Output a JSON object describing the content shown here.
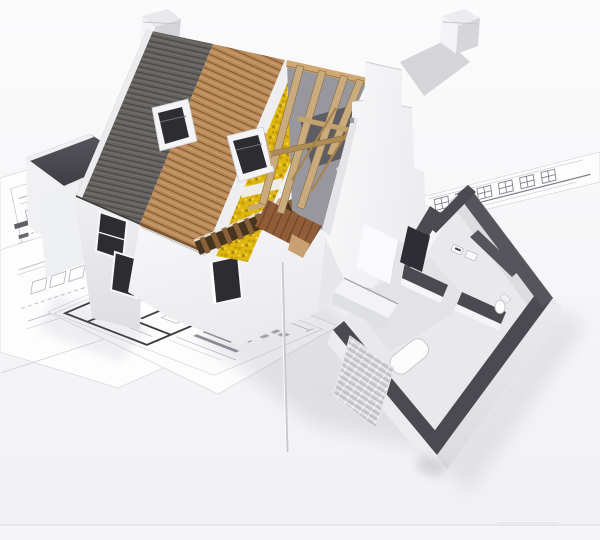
{
  "scene": {
    "description": "3D cutaway architectural rendering of a house under construction standing on spread-out blueprint floor plans against a white background. The roof is peeled back in strips showing slate tiles, timber decking, membrane, yellow mineral insulation and open rafters; a stepped gable wall, two skylights and two chimneys are visible; the single-storey wing is roofless, exposing rooms with dark-grey cut wall tops, kitchen units and bathroom fixtures.",
    "background_top": "#fbfbfc",
    "background_bottom": "#f1f1f4"
  },
  "palette": {
    "roof_tile": "#666360",
    "roof_tile_dark": "#4d4b49",
    "wood_deck": "#b9895a",
    "wood_deck_dark": "#7e5631",
    "insulation_yellow": "#dfb60e",
    "insulation_dark": "#a8870a",
    "insulation_light": "#f0cf3e",
    "rafter_wood": "#c9ab7e",
    "purlin_wood": "#b08c55",
    "ridge_beam": "#cfa873",
    "attic_floor": "#915d39",
    "eave_joist_bg": "#47351f",
    "eave_joist_stripe": "#8a6238",
    "charcoal_wall_top": "#4a4a50",
    "charcoal_wall_top_light": "#55555b",
    "white_wall": "#f5f5f7",
    "wall_shade": "#e2e2e6",
    "interior_floor": "#e9e9ec",
    "window_glass": "#2c2c31",
    "dark_cabinet": "#2d2d33",
    "paper": "#fdfdfe",
    "blueprint_line": "#9b9ba4",
    "blueprint_dark": "#3a3a40",
    "back_roof": "#c7c7cd",
    "shadow": "#777788"
  },
  "objects": {
    "chimney_count": 2,
    "skylight_count": 2,
    "blueprint_sheet_count": 4,
    "roof_layers": [
      "slate tiles",
      "timber deck",
      "membrane",
      "mineral insulation",
      "membrane",
      "open rafters"
    ],
    "rooms_visible": [
      "kitchen",
      "hallway",
      "bathroom"
    ],
    "fixtures": [
      "kitchen counter",
      "tall cabinet",
      "bathtub",
      "toilet",
      "sink vanity",
      "downpipe",
      "brick lattice wall"
    ]
  }
}
